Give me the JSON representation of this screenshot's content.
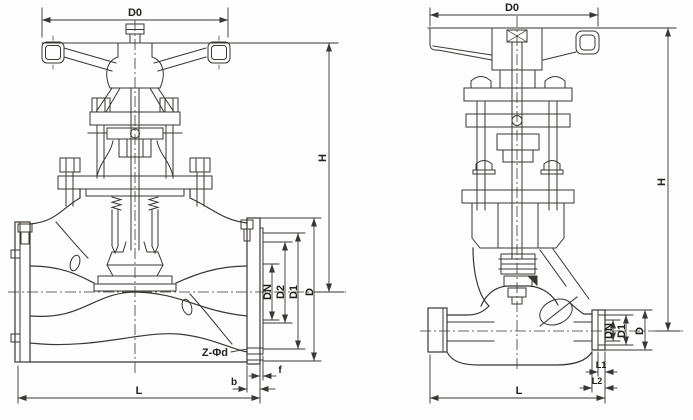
{
  "colors": {
    "line": "#3a3633",
    "text": "#24201d",
    "background": "#fdfdfd"
  },
  "left_view": {
    "labels": {
      "d0": "D0",
      "h": "H",
      "dn": "DN",
      "d2": "D2",
      "d1": "D1",
      "d": "D",
      "bolt_circle": "Z-Φd",
      "b": "b",
      "f": "f",
      "l": "L"
    }
  },
  "right_view": {
    "labels": {
      "d0": "D0",
      "h": "H",
      "dn": "DN",
      "d1": "D1",
      "d": "D",
      "l1": "L1",
      "l2": "L2",
      "l": "L"
    }
  }
}
